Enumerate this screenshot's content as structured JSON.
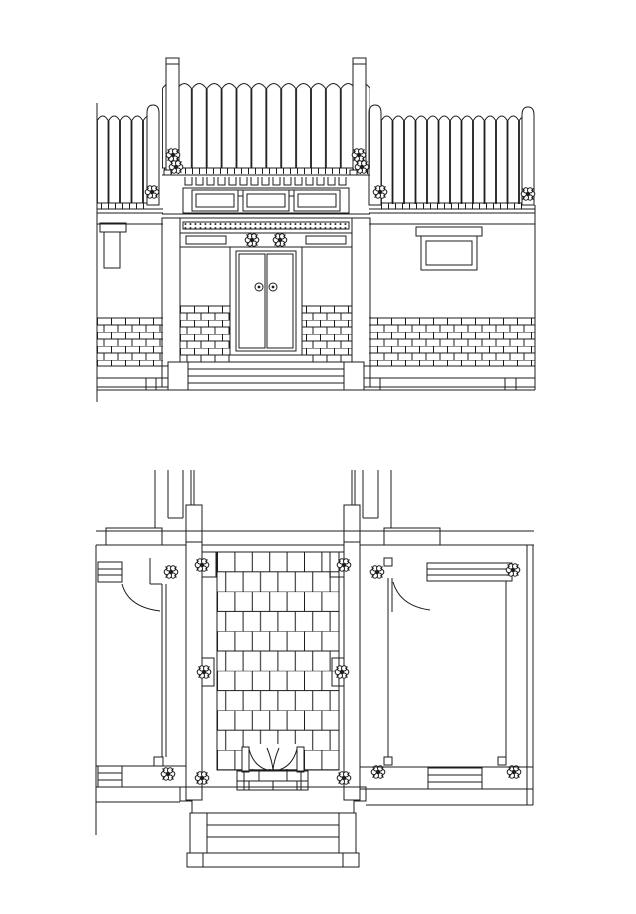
{
  "canvas": {
    "width": 636,
    "height": 914,
    "background": "#ffffff",
    "line_color": "#1c1c1c",
    "drawing_type": "architectural CAD line drawing, traditional Chinese gate"
  },
  "elevation": {
    "panel_count": 3,
    "door_leaf_count": 2,
    "door_knocker_count": 2,
    "lintel_ornament_count": 2,
    "eave_ornament_count": 2,
    "side_ornament_count": 3,
    "ridge_post_count": 2,
    "window_count": 1,
    "niche_count": 1,
    "step_line_count": 4,
    "brick_panel_count": 4
  },
  "plan": {
    "column_flower_count": 12,
    "door_leaf_count": 2,
    "paving_columns": 7,
    "paving_rows": 11,
    "step_line_count": 3,
    "wall_cap_count": 2,
    "lattice_bar_count": 2
  }
}
